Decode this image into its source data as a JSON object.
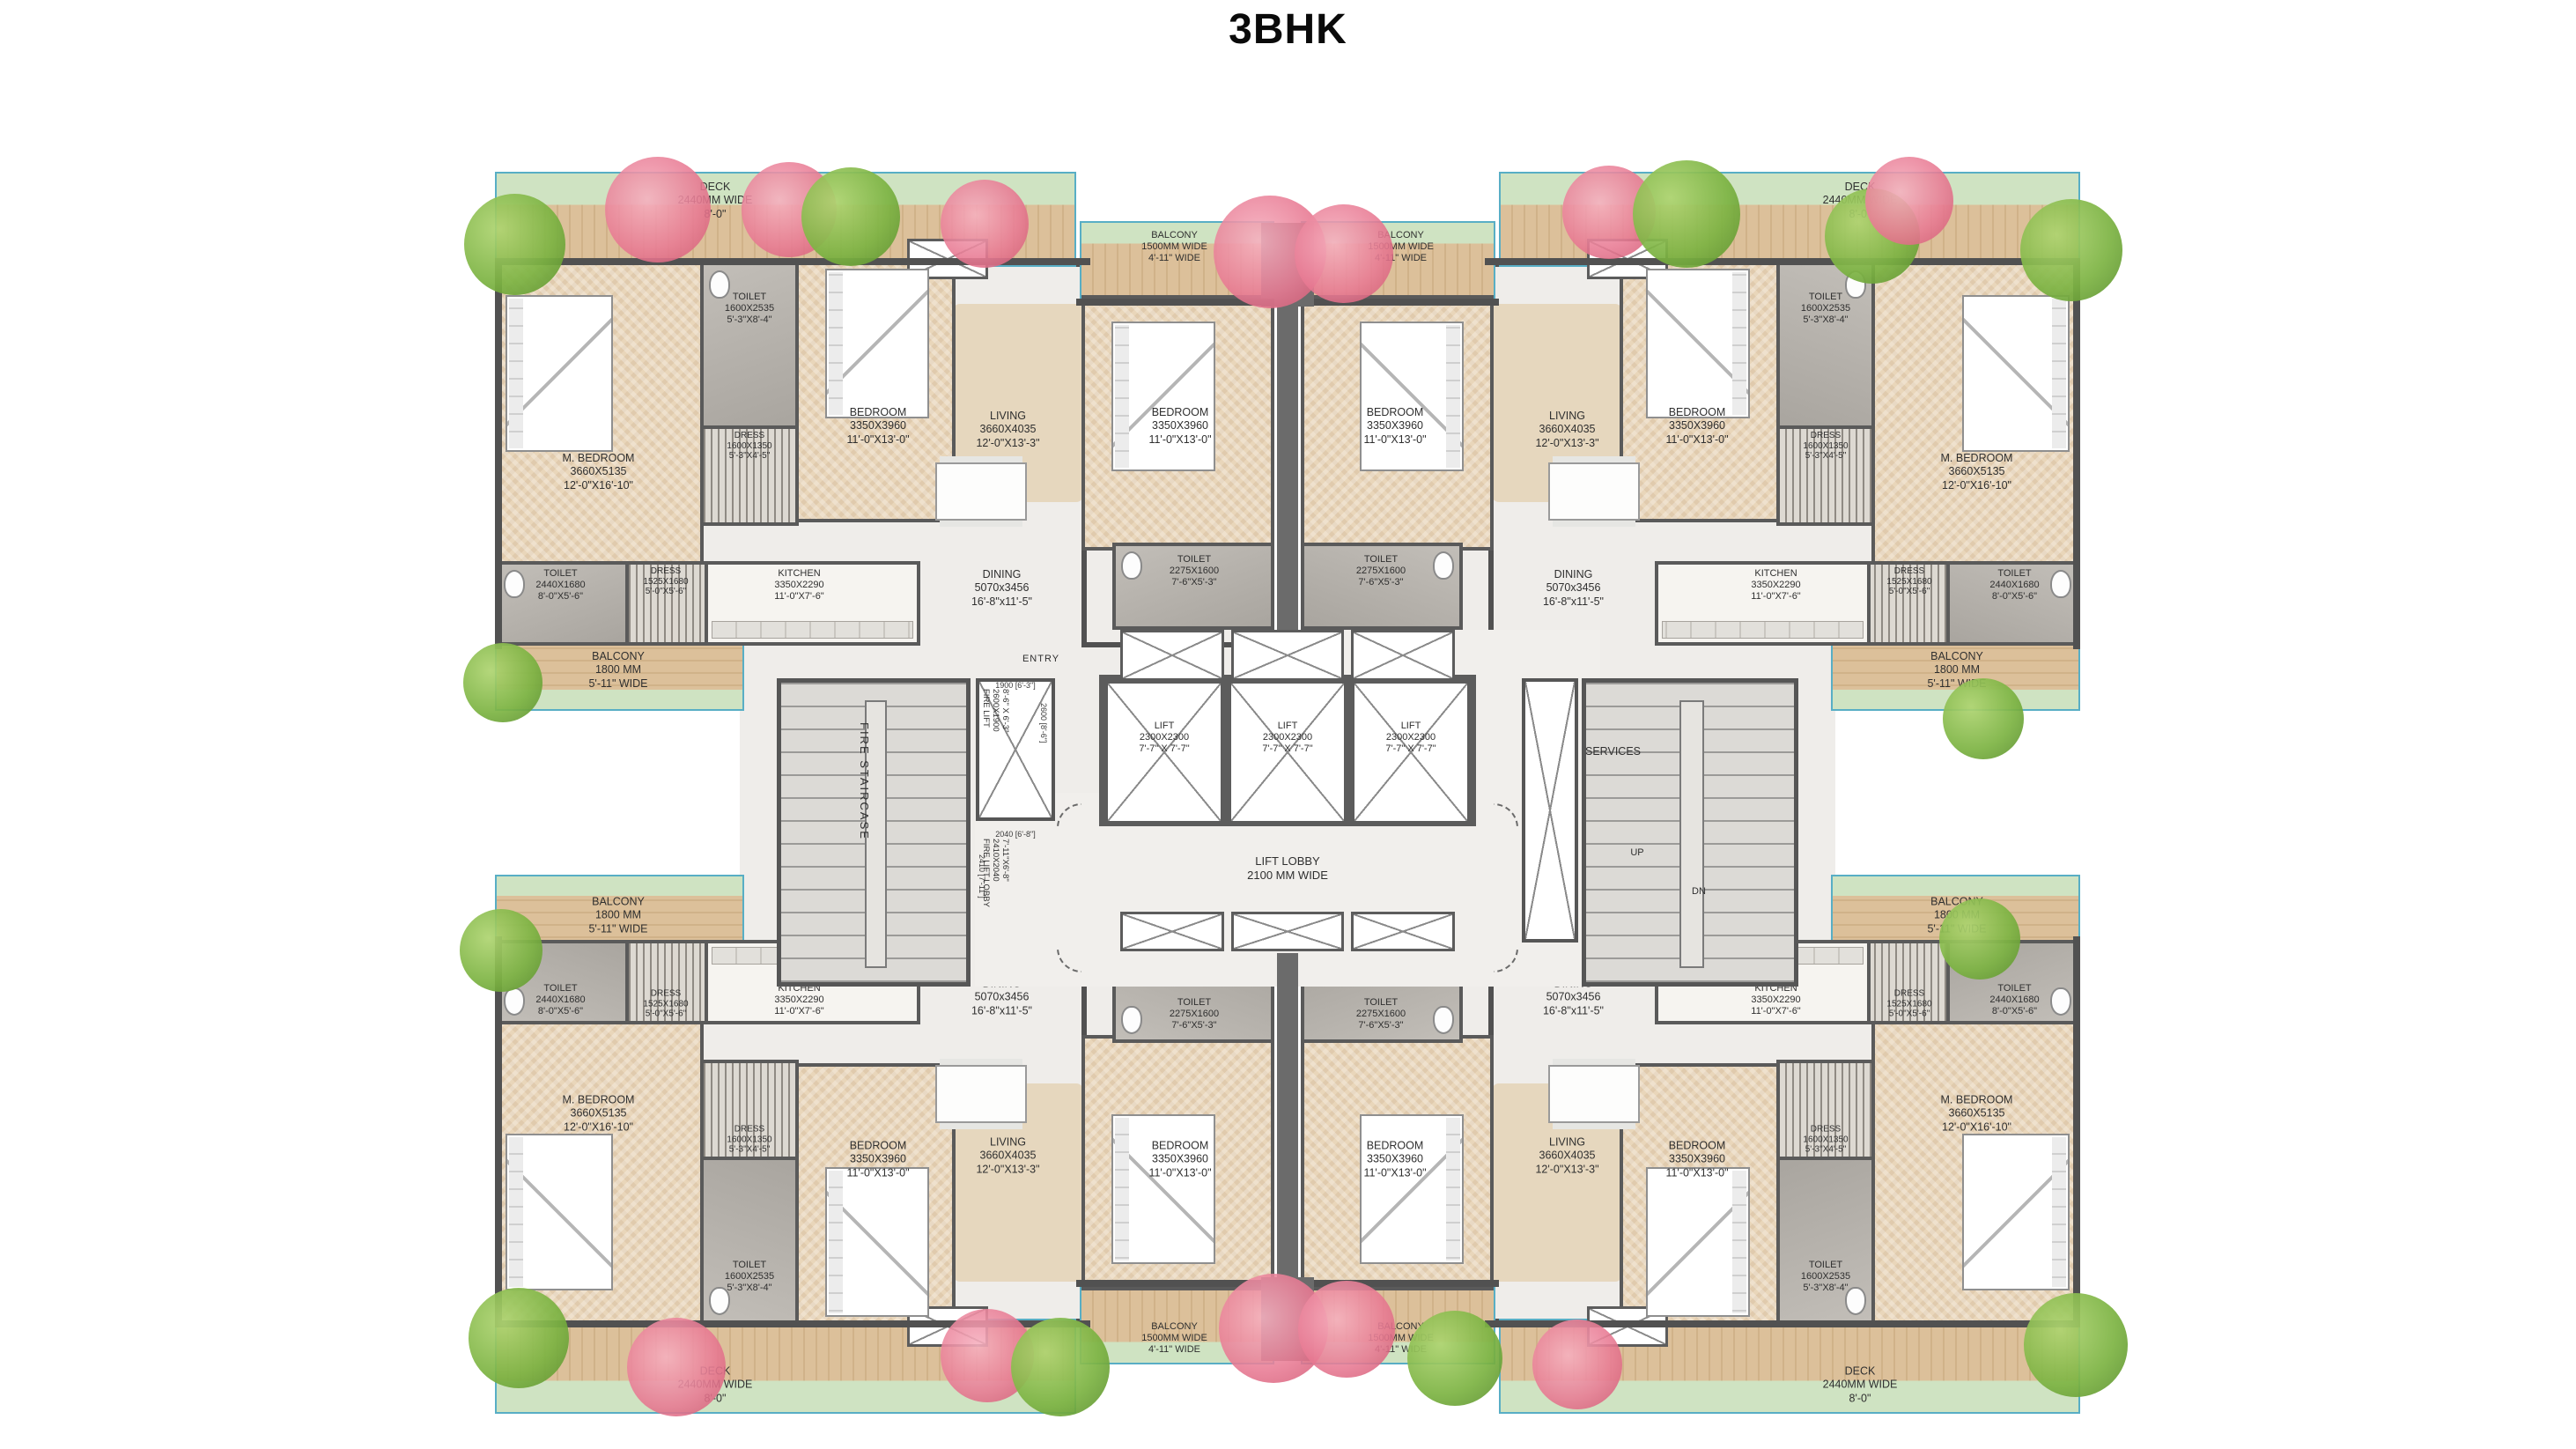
{
  "title": "3BHK",
  "colors": {
    "wall": "#5a5a5a",
    "wood_deck": "#d8bb94",
    "lawn": "#cfe3c2",
    "pool_edge_teal": "#58aec5",
    "bedroom_floor": "#e9d6ba",
    "toilet_floor": "#b3afa9",
    "tree_green": "#7cb342",
    "tree_pink": "#e87a93"
  },
  "rooms": {
    "m_bedroom": {
      "name": "M. BEDROOM",
      "mm": "3660X5135",
      "ft": "12'-0\"X16'-10\""
    },
    "bedroom": {
      "name": "BEDROOM",
      "mm": "3350X3960",
      "ft": "11'-0\"X13'-0\""
    },
    "living": {
      "name": "LIVING",
      "mm": "3660X4035",
      "ft": "12'-0\"X13'-3\""
    },
    "dining": {
      "name": "DINING",
      "mm": "5070x3456",
      "ft": "16'-8\"x11'-5\""
    },
    "kitchen": {
      "name": "KITCHEN",
      "mm": "3350X2290",
      "ft": "11'-0\"X7'-6\""
    },
    "toilet_master": {
      "name": "TOILET",
      "mm": "1600X2535",
      "ft": "5'-3\"X8'-4\""
    },
    "toilet_common": {
      "name": "TOILET",
      "mm": "2440X1680",
      "ft": "8'-0\"X5'-6\""
    },
    "toilet_center": {
      "name": "TOILET",
      "mm": "2275X1600",
      "ft": "7'-6\"X5'-3\""
    },
    "dress_master": {
      "name": "DRESS",
      "mm": "1600X1350",
      "ft": "5'-3\"X4'-5\""
    },
    "dress_common": {
      "name": "DRESS",
      "mm": "1525X1680",
      "ft": "5'-0\"X5'-6\""
    },
    "deck": {
      "name": "DECK",
      "mm": "2440MM WIDE",
      "ft": "8'-0\""
    },
    "balcony_front": {
      "name": "BALCONY",
      "mm": "1500MM WIDE",
      "ft": "4'-11\" WIDE"
    },
    "balcony_side": {
      "name": "BALCONY",
      "mm": "1800 MM",
      "ft": "5'-11\" WIDE"
    }
  },
  "core": {
    "lift": {
      "name": "LIFT",
      "mm": "2300X2300",
      "ft": "7'-7\" X 7'-7\""
    },
    "lift_lobby": {
      "name": "LIFT LOBBY",
      "width": "2100 MM WIDE"
    },
    "fire_staircase": {
      "name": "FIRE STAIRCASE"
    },
    "fire_lift": {
      "name": "FIRE LIFT",
      "mm": "2600X1900",
      "ft": "8'-6\" X 6'-3\"",
      "dim_w": "1900 [6'-3\"]",
      "dim_h": "2600 [8'-6\"]"
    },
    "fire_lift_lobby": {
      "name": "FIRE LIFT LOBBY",
      "mm": "2410X2040",
      "ft": "7'-11\"X6'-8\"",
      "dim_w": "2040 [6'-8\"]",
      "dim_h": "2410 [7'-11\"]"
    },
    "services": {
      "name": "SERVICES"
    },
    "stair_up": "UP",
    "stair_dn": "DN",
    "entry": "ENTRY"
  }
}
